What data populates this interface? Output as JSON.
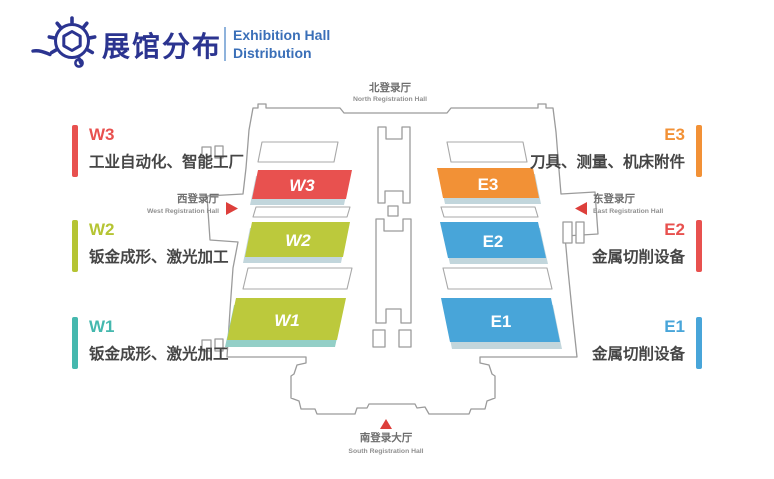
{
  "header": {
    "title_zh": "展馆分布",
    "title_en_line1": "Exhibition Hall",
    "title_en_line2": "Distribution",
    "logo_icon": "gear-hexagon-icon"
  },
  "west_labels": [
    {
      "code": "W3",
      "desc": "工业自动化、智能工厂",
      "color": "#E8514F"
    },
    {
      "code": "W2",
      "desc": "钣金成形、激光加工",
      "color": "#B5C433"
    },
    {
      "code": "W1",
      "desc": "钣金成形、激光加工",
      "color": "#45B8AE"
    }
  ],
  "east_labels": [
    {
      "code": "E3",
      "desc": "刀具、测量、机床附件",
      "color": "#F29136"
    },
    {
      "code": "E2",
      "desc": "金属切削设备",
      "color": "#E8514F"
    },
    {
      "code": "E1",
      "desc": "金属切削设备",
      "color": "#48A5D9"
    }
  ],
  "map": {
    "halls": [
      {
        "code": "W3",
        "color": "#E8514F"
      },
      {
        "code": "W2",
        "color": "#BCC93C"
      },
      {
        "code": "W1",
        "color": "#BCC93C"
      },
      {
        "code": "E3",
        "color": "#F29136"
      },
      {
        "code": "E2",
        "color": "#48A5D9"
      },
      {
        "code": "E1",
        "color": "#48A5D9"
      }
    ],
    "entrances": {
      "north": {
        "zh": "北登录厅",
        "en": "North Registration Hall"
      },
      "west": {
        "zh": "西登录厅",
        "en": "West Registration Hall"
      },
      "east": {
        "zh": "东登录厅",
        "en": "East Registration Hall"
      },
      "south": {
        "zh": "南登录大厅",
        "en": "South Registration Hall"
      }
    }
  },
  "colors": {
    "brand_navy": "#2B3490",
    "brand_blue": "#3A6FB8",
    "outline_gray": "#9B9B9B",
    "arrow_red": "#DD3F3B",
    "hall_base_shadow": "#C2D6DC",
    "hall_base_teal": "#93CFC7"
  }
}
